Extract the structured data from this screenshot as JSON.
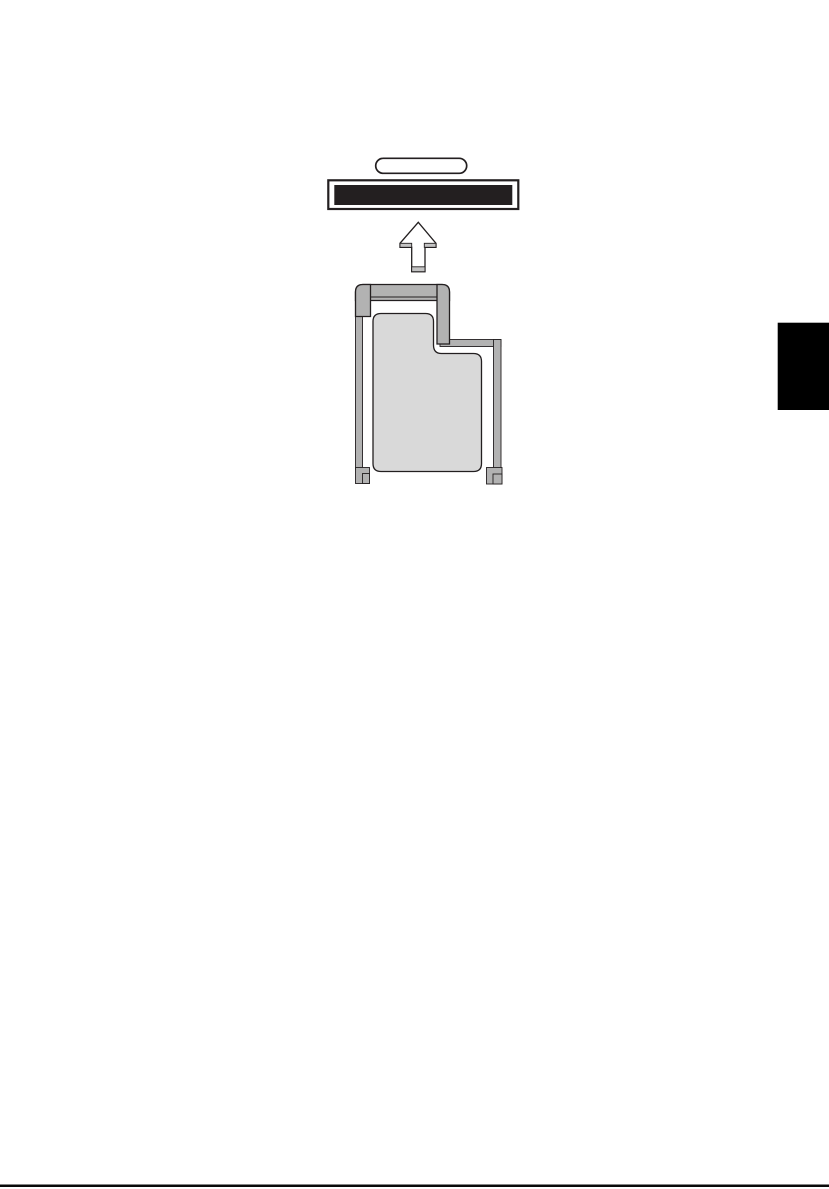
{
  "document": {
    "kind": "manual-page-illustration",
    "visible_text": [],
    "page_background": "#ffffff"
  },
  "figure": {
    "label": "expresscard-insertion-diagram",
    "parts": [
      "eject-button",
      "expresscard-slot-opening",
      "insertion-direction-up-arrow",
      "expresscard-with-frame"
    ]
  },
  "colors": {
    "outline_black": "#231f20",
    "slot_fill": "#231f20",
    "frame_gray": "#b2b2b2",
    "card_body_gray": "#d9d9d9",
    "shade_gray": "#c3c3c3",
    "white_fill": "#ffffff",
    "edge_tab_black": "#000000",
    "bottom_rule_black": "#0a0a0a"
  }
}
